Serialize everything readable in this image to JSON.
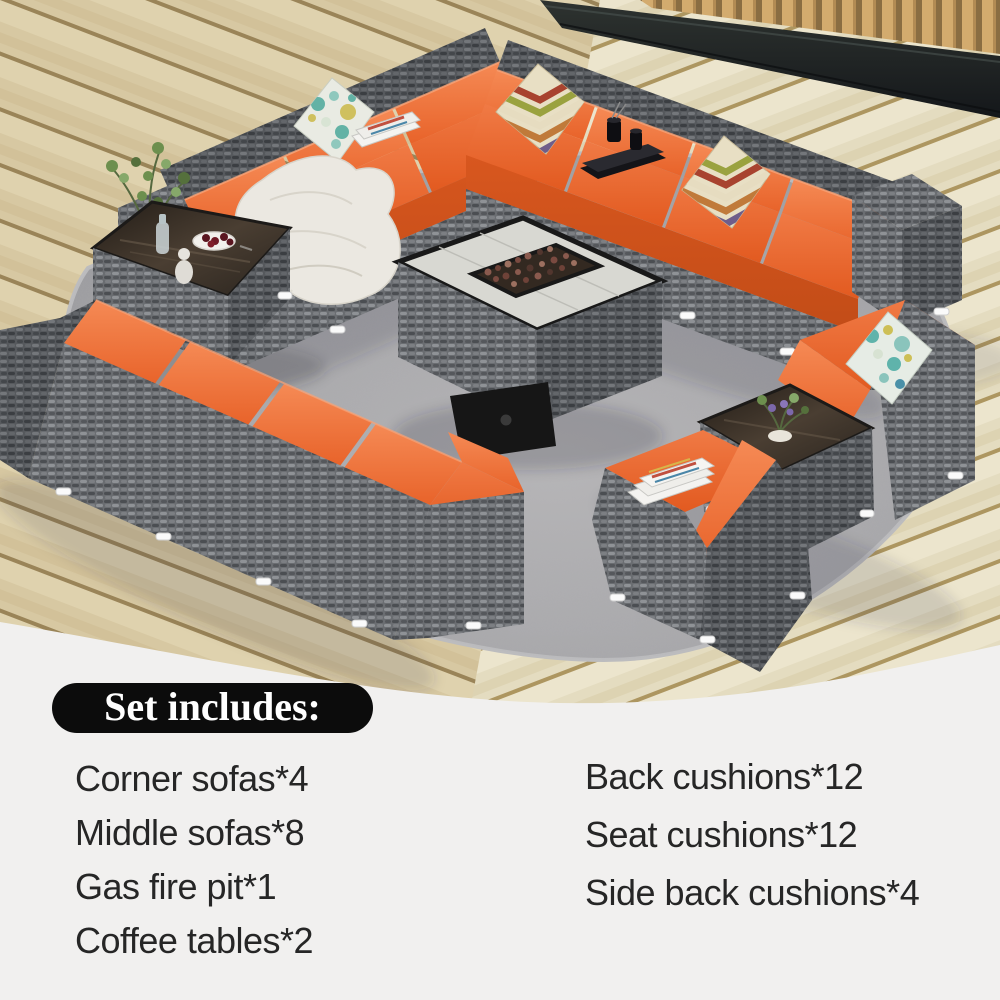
{
  "set_includes": {
    "title": "Set includes:",
    "left_items": [
      "Corner sofas*4",
      "Middle sofas*8",
      "Gas fire pit*1",
      "Coffee tables*2"
    ],
    "right_items": [
      "Back cushions*12",
      "Seat cushions*12",
      "Side back cushions*4"
    ]
  },
  "colors": {
    "cushion_orange": "#e8632a",
    "cushion_orange_light": "#f58a55",
    "wicker_gray": "#66696d",
    "rug_gray": "#a1a1a4",
    "deck_wood_tan": "#d8c9a3",
    "badge_black": "#0c0c0c",
    "text_dark": "#262626",
    "caption_background": "#f1f0ef"
  },
  "scene": {
    "items": [
      "wood-deck",
      "privacy-screen",
      "stone-border",
      "area-rug",
      "corner-sofas",
      "middle-sofas",
      "gas-fire-pit-table",
      "coffee-tables",
      "orange-back-cushions",
      "orange-seat-cushions",
      "chevron-throw-pillows",
      "floral-throw-pillows",
      "white-throw-blanket",
      "magazines",
      "black-vases-and-book",
      "potted-plant",
      "fruit-bowl"
    ]
  }
}
